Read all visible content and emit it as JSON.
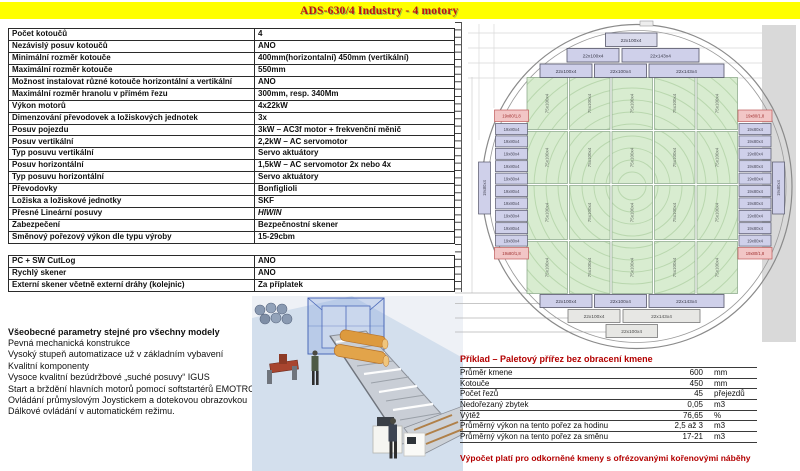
{
  "header": {
    "title": "ADS-630/4 Industry - 4 motory"
  },
  "spec_table": {
    "rows": [
      {
        "label": "Počet kotoučů",
        "value": "4"
      },
      {
        "label": "Nezávislý posuv kotoučů",
        "value": "ANO"
      },
      {
        "label": "Minimální rozměr kotouče",
        "value": "400mm(horizontalní) 450mm (vertikální)"
      },
      {
        "label": "Maximální rozměr kotouče",
        "value": "550mm"
      },
      {
        "label": "Možnost instalovat různé kotouče horizontální a vertikální",
        "value": "ANO"
      },
      {
        "label": "Maximální rozměr hranolu v přímém řezu",
        "value": "300mm, resp. 340Mm"
      },
      {
        "label": "Výkon motorů",
        "value": "4x22kW"
      },
      {
        "label": "Dimenzování převodovek a ložiskových jednotek",
        "value": "3x"
      },
      {
        "label": "Posuv pojezdu",
        "value": "3kW – AC3f motor + frekvenční měnič"
      },
      {
        "label": "Posuv vertikální",
        "value": "2,2kW – AC servomotor"
      },
      {
        "label": "Typ posuvu vertikální",
        "value": "Servo aktuátory"
      },
      {
        "label": "Posuv horizontální",
        "value": "1,5kW – AC servomotor  2x nebo 4x"
      },
      {
        "label": "Typ posuvu horizontální",
        "value": "Servo aktuátory"
      },
      {
        "label": "Převodovky",
        "value": "Bonfiglioli"
      },
      {
        "label": "Ložiska a ložiskové jednotky",
        "value": "SKF"
      },
      {
        "label": "Přesné Lineární posuvy",
        "value": "HIWIN"
      },
      {
        "label": "Zabezpečení",
        "value": "Bezpečnostní skener"
      },
      {
        "label": "Směnový pořezový výkon dle typu výroby",
        "value": "15-29cbm"
      }
    ]
  },
  "options_table": {
    "rows": [
      {
        "label": "PC + SW CutLog",
        "value": "ANO"
      },
      {
        "label": "Rychlý skener",
        "value": "ANO"
      },
      {
        "label": "Externí skener včetně externí dráhy (kolejnic)",
        "value": "Za příplatek"
      }
    ]
  },
  "general": {
    "heading": "Všeobecné parametry stejné pro všechny modely",
    "lines": [
      "Pevná mechanická konstrukce",
      "Vysoký stupeň automatizace už v základním vybavení",
      "Kvalitní komponenty",
      "Vysoce kvalitní bezúdržbové „suché posuvy“  IGUS",
      "Start a brždění hlavních motorů pomocí softstartérů EMOTRON",
      "Ovládání průmyslovým Joystickem a dotekovou obrazovkou",
      "Dálkové ovládání v automatickém režimu."
    ]
  },
  "diagram": {
    "top_rows": [
      {
        "labels": [
          "22x100x4"
        ]
      },
      {
        "labels": [
          "22x100x4",
          "22x143x4"
        ]
      },
      {
        "labels": [
          "22x100x4",
          "22x100x4",
          "22x143x4"
        ]
      }
    ],
    "bottom_rows": [
      {
        "labels": [
          "22x100x4",
          "22x100x4",
          "22x143x4"
        ]
      },
      {
        "labels": [
          "22x100x4",
          "22x143x4"
        ]
      },
      {
        "labels": [
          "22x100x4"
        ]
      }
    ],
    "center_block_label": "75x100x4",
    "side_board_label": "19x80x4",
    "side_special_label": "19x80/1,8"
  },
  "example_table": {
    "title": "Příklad – Paletový přířez bez obracení kmene",
    "rows": [
      {
        "label": "Průměr kmene",
        "value": "600",
        "unit": "mm"
      },
      {
        "label": "Kotouče",
        "value": "450",
        "unit": "mm"
      },
      {
        "label": "Počet řezů",
        "value": "45",
        "unit": "přejezdů"
      },
      {
        "label": "Nedořezaný zbytek",
        "value": "0,05",
        "unit": "m3"
      },
      {
        "label": "Výtěž",
        "value": "76,65",
        "unit": "%"
      },
      {
        "label": "Průměrný výkon na tento pořez za hodinu",
        "value": "2,5 až 3",
        "unit": "m3"
      },
      {
        "label": "Průměrný výkon na tento pořez za směnu",
        "value": "17-21",
        "unit": "m3"
      }
    ],
    "footer": "Výpočet platí pro odkorněné kmeny s ofrézovanými kořenovými náběhy"
  },
  "colors": {
    "accent_yellow": "#ffff00",
    "title_red": "#c01010",
    "dark_red": "#b30000",
    "green_block": "#d8ecd0",
    "board_lavender": "#cfd0ea",
    "board_pink": "#f2c6c6",
    "gray_band": "#d9d9d9"
  }
}
